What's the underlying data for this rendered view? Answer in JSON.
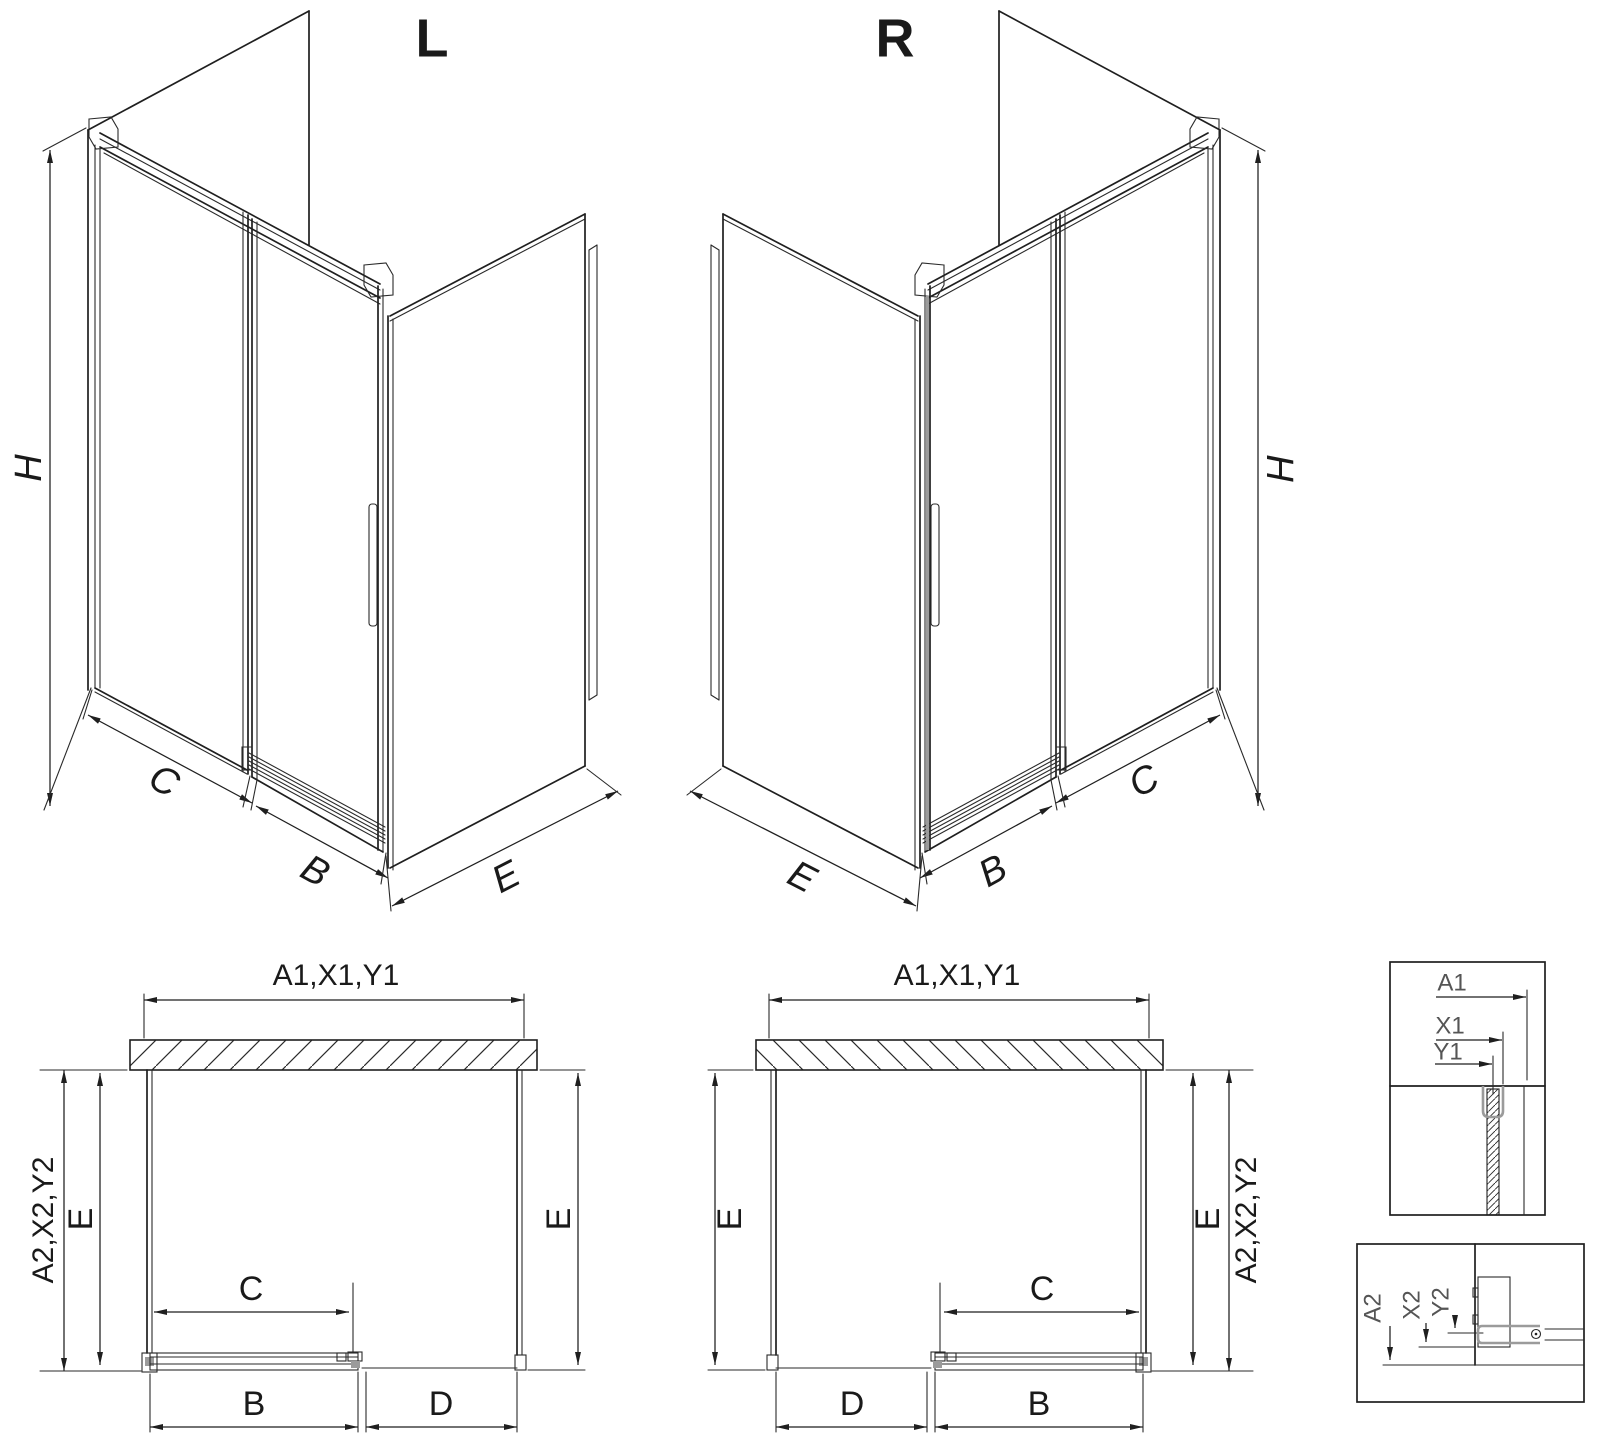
{
  "drawing": {
    "type": "technical-diagram",
    "subject": "corner sliding-door shower enclosure, left (L) and right (R) versions",
    "colors": {
      "line": "#1f1f1f",
      "profile_gray": "#9b9b9b",
      "background": "#ffffff"
    }
  },
  "iso_left": {
    "label": "L",
    "dim_height": "H",
    "dim_fixed": "C",
    "dim_door": "B",
    "dim_side": "E"
  },
  "iso_right": {
    "label": "R",
    "dim_height": "H",
    "dim_fixed": "C",
    "dim_door": "B",
    "dim_side": "E"
  },
  "plan_left": {
    "dim_top": "A1,X1,Y1",
    "dim_outer": "A2,X2,Y2",
    "dim_side_left": "E",
    "dim_side_right": "E",
    "dim_opening": "C",
    "dim_door": "B",
    "dim_fixed": "D"
  },
  "plan_right": {
    "dim_top": "A1,X1,Y1",
    "dim_outer": "A2,X2,Y2",
    "dim_side_left": "E",
    "dim_side_right": "E",
    "dim_opening": "C",
    "dim_door": "B",
    "dim_fixed": "D"
  },
  "detail_top": {
    "labels": [
      "A1",
      "X1",
      "Y1"
    ]
  },
  "detail_bottom": {
    "labels": [
      "A2",
      "X2",
      "Y2"
    ]
  }
}
